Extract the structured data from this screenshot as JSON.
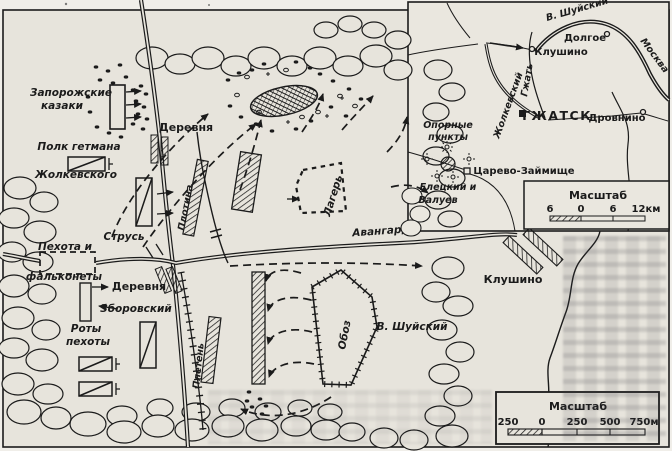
{
  "colors": {
    "paper": "#e7e4dc",
    "ink": "#1b1b1b"
  },
  "main_map": {
    "labels": {
      "zaporozhian_1": "Запорожские",
      "zaporozhian_2": "казаки",
      "hetman_1": "Полк гетмана",
      "hetman_2": "Жолкевского",
      "village_north": "Деревня",
      "strus": "Струсь",
      "infantry_1": "Пехота и",
      "infantry_2": "фальконеты",
      "village_south": "Деревня",
      "zborovsky": "Зборовский",
      "companies_1": "Роты",
      "companies_2": "пехоты",
      "dam": "Плотина",
      "fence": "Плетень",
      "camp": "Лагерь",
      "vanguards": "Авангарды",
      "baggage_train": "Обоз",
      "shuisky": "В. Шуйский",
      "klushino": "Клушино"
    },
    "scale": {
      "title": "Масштаб",
      "ticks": [
        "250",
        "0",
        "250",
        "500",
        "750м"
      ]
    }
  },
  "inset_map": {
    "labels": {
      "shuisky_route": "В. Шуйский",
      "dolgoe": "Долгое",
      "klushino": "Клушино",
      "moscow": "Москва",
      "gzhat_river": "Гжать",
      "zholkievsky_route": "Жолкевский",
      "gzhatsk": "ГЖАТСК",
      "drovnino": "Дровнино",
      "strongpoints_1": "Опорные",
      "strongpoints_2": "пункты",
      "tsarevo_zaymishche": "Царево-Займище",
      "commanders_1": "Елецкий и",
      "commanders_2": "Валуев"
    },
    "scale": {
      "title": "Масштаб",
      "ticks": [
        "6",
        "0",
        "6",
        "12км"
      ]
    }
  }
}
